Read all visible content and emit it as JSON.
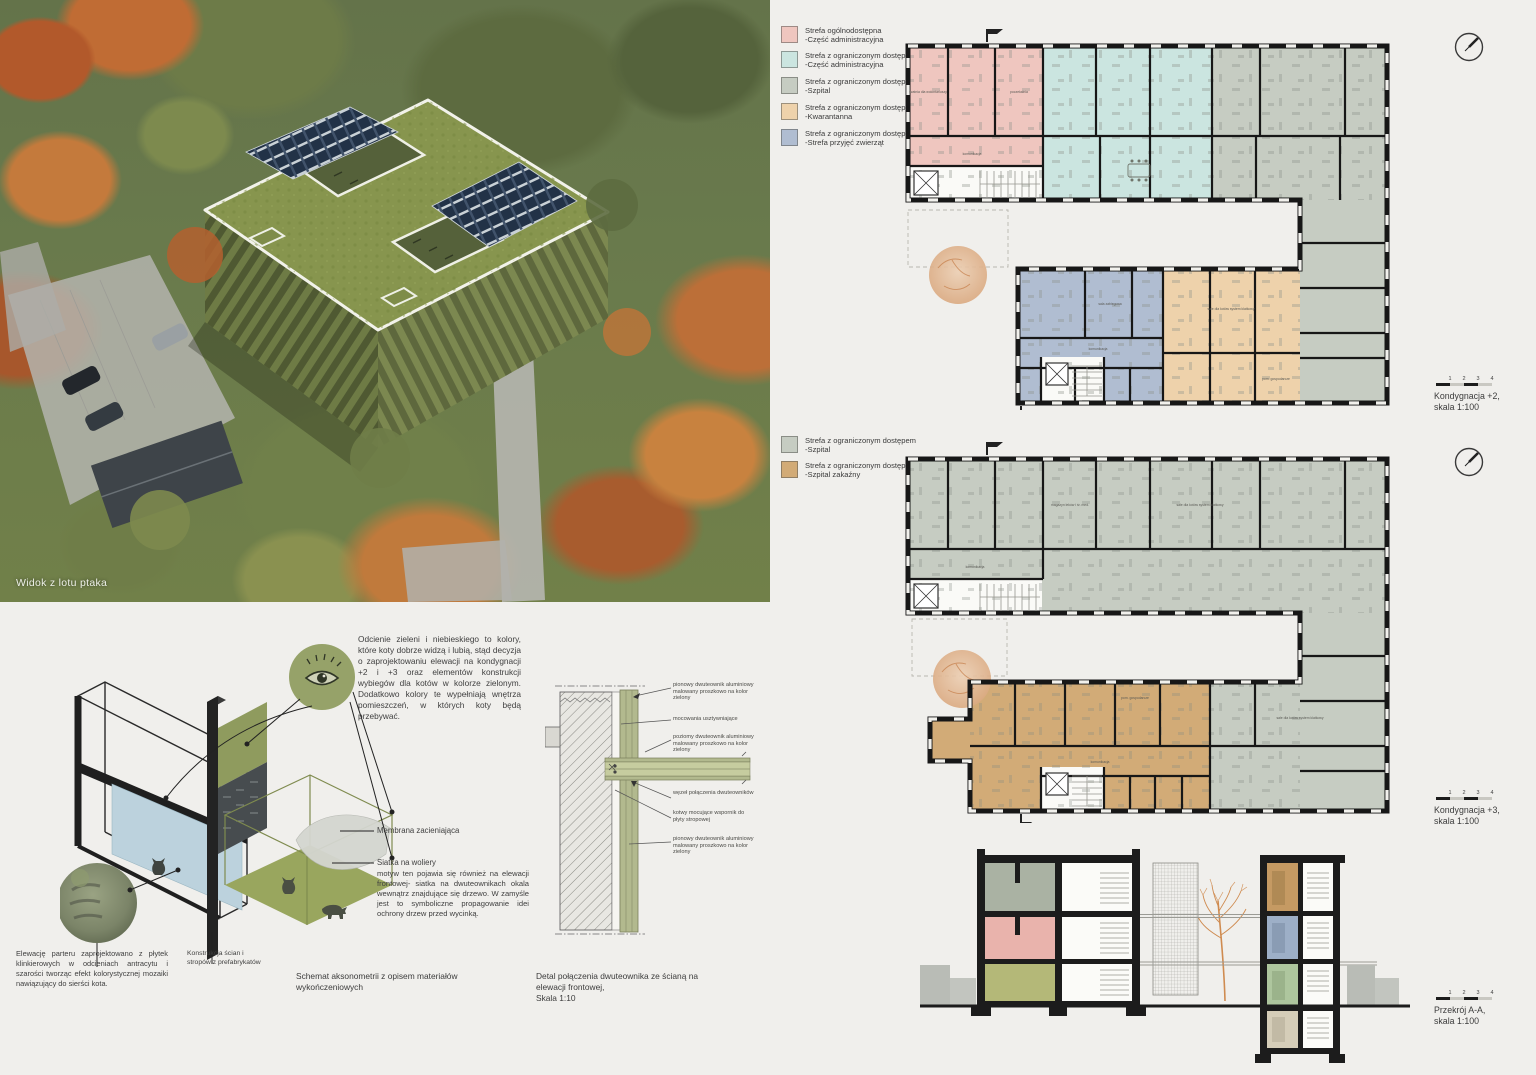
{
  "colors": {
    "paper": "#f0efec",
    "wall": "#1a1a1a",
    "zone_public_pink": "#efc6bf",
    "zone_admin_teal": "#cbe5e0",
    "zone_hospital_gray": "#c6ccc2",
    "zone_quarantine_orange": "#eed2ab",
    "zone_intake_blue": "#b0bdd1",
    "zone_infectious_tan": "#d2ab77",
    "beam_green": "#b2b98e",
    "roof_green": "#87954e",
    "solar_navy": "#223247",
    "accent_olive": "#96a269"
  },
  "render": {
    "caption": "Widok z lotu ptaka"
  },
  "legend_plan2": {
    "items": [
      {
        "color": "#efc6bf",
        "line1": "Strefa ogólnodostępna",
        "line2": "-Część administracyjna"
      },
      {
        "color": "#cbe5e0",
        "line1": "Strefa z ograniczonym dostępem",
        "line2": "-Część administracyjna"
      },
      {
        "color": "#c6ccc2",
        "line1": "Strefa z ograniczonym dostępem",
        "line2": "-Szpital"
      },
      {
        "color": "#eed2ab",
        "line1": "Strefa z ograniczonym dostępem",
        "line2": "-Kwarantanna"
      },
      {
        "color": "#b0bdd1",
        "line1": "Strefa z ograniczonym dostępem",
        "line2": "-Strefa przyjęć zwierząt"
      }
    ]
  },
  "legend_plan3": {
    "items": [
      {
        "color": "#c6ccc2",
        "line1": "Strefa z ograniczonym dostępem",
        "line2": "-Szpital"
      },
      {
        "color": "#d2ab77",
        "line1": "Strefa z ograniczonym dostępem",
        "line2": "-Szpital zakaźny"
      }
    ]
  },
  "plans": {
    "scalebar": [
      "1",
      "2",
      "3",
      "4"
    ],
    "plan2": {
      "caption1": "Kondygnacja +2,",
      "caption2": "skala 1:100",
      "room_labels": [
        "komunikacja",
        "poczekalnia",
        "szatnia dla wolontariuszy",
        "sala zabiegowa",
        "sale dla kotów system klatkowy",
        "pom. gospodarcze"
      ]
    },
    "plan3": {
      "caption1": "Kondygnacja +3,",
      "caption2": "skala 1:100",
      "room_labels": [
        "komunikacja",
        "sale dla kotów system klatkowy",
        "magazyn leków i śr. med.",
        "pom. gospodarcze"
      ]
    },
    "section": {
      "caption1": "Przekrój A-A,",
      "caption2": "skala 1:100"
    }
  },
  "axon": {
    "paragraph": "Odcienie zieleni i niebieskiego to kolory, które koty dobrze widzą i lubią, stąd decyzja o zaprojektowaniu elewacji na kondygnacji +2 i +3 oraz elementów konstrukcji wybiegów dla kotów w kolorze zielonym. Dodatkowo kolory te wypełniają wnętrza pomieszczeń, w których koty będą przebywać.",
    "label_membrane": "Membrana zacieniająca",
    "label_mesh_title": "Siatka na woliery",
    "label_mesh_body": "motyw ten pojawia się również na elewacji frontowej- siatka na dwuteownikach okala wewnątrz znajdujące się drzewo. W zamyśle jest to symboliczne propagowanie idei ochrony drzew przed wycinką.",
    "caption_left": "Elewację parteru zaprojektowano z płytek klinkierowych w odcieniach antracytu i szarości tworząc efekt kolorystycznej mozaiki nawiązujący do sierści kota.",
    "caption_mid": "Konstrukcja ścian i stropów z prefabrykatów",
    "caption_schemat": "Schemat aksonometrii z opisem materiałów wykończeniowych"
  },
  "detail": {
    "caption": "Detal połączenia dwuteownika ze ścianą na elewacji frontowej,",
    "caption_scale": "Skala 1:10",
    "labels": [
      "pionowy dwuteownik aluminiowy malowany proszkowo na kolor zielony",
      "mocowania usztywniające",
      "poziomy dwuteownik aluminiowy malowany proszkowo na kolor zielony",
      "węzeł połączenia dwuteowników",
      "kotwy mocujące wspornik do płyty stropowej",
      "pionowy dwuteownik aluminiowy malowany proszkowo na kolor zielony"
    ]
  }
}
